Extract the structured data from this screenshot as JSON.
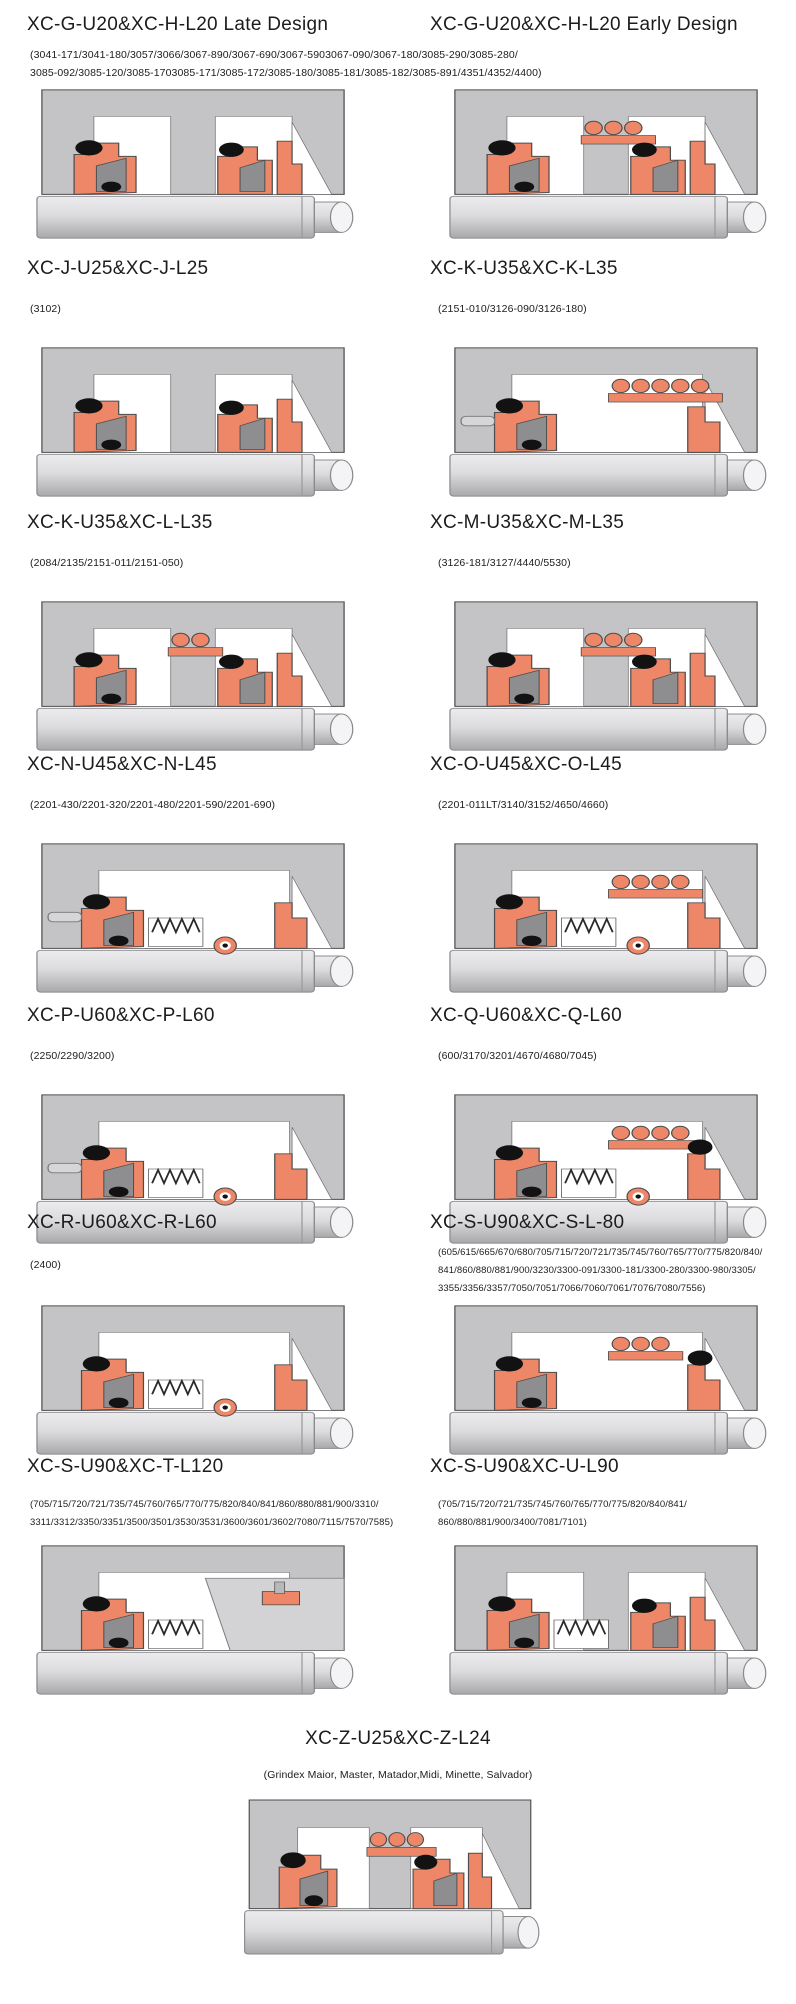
{
  "page": {
    "background": "#ffffff"
  },
  "colors": {
    "housing": "#c4c4c6",
    "cavity": "#ffffff",
    "seal_orange": "#ee8767",
    "component_black": "#121212",
    "wedge_gray": "#8e8e90",
    "shaft_light": "#dcdcde",
    "shaft_dark": "#a8a8aa",
    "outline": "#4d4d4d",
    "text": "#1c1c1c"
  },
  "rows": [
    {
      "cells": [
        {
          "title": "XC-G-U20&XC-H-L20 Late Design"
        },
        {
          "title": "XC-G-U20&XC-H-L20 Early Design"
        }
      ],
      "shared_models": "(3041-171/3041-180/3057/3066/3067-890/3067-690/3067-5903067-090/3067-180/3085-290/3085-280/\n3085-092/3085-120/3085-1703085-171/3085-172/3085-180/3085-181/3085-182/3085-891/4351/4352/4400)"
    },
    {
      "cells": [
        {
          "title": "XC-J-U25&XC-J-L25",
          "models": "(3102)"
        },
        {
          "title": "XC-K-U35&XC-K-L35",
          "models": "(2151-010/3126-090/3126-180)"
        }
      ]
    },
    {
      "cells": [
        {
          "title": "XC-K-U35&XC-L-L35",
          "models": "(2084/2135/2151-011/2151-050)"
        },
        {
          "title": "XC-M-U35&XC-M-L35",
          "models": "(3126-181/3127/4440/5530)"
        }
      ]
    },
    {
      "cells": [
        {
          "title": "XC-N-U45&XC-N-L45",
          "models": "(2201-430/2201-320/2201-480/2201-590/2201-690)"
        },
        {
          "title": "XC-O-U45&XC-O-L45",
          "models": "(2201-011LT/3140/3152/4650/4660)"
        }
      ]
    },
    {
      "cells": [
        {
          "title": "XC-P-U60&XC-P-L60",
          "models": "(2250/2290/3200)"
        },
        {
          "title": "XC-Q-U60&XC-Q-L60",
          "models": "(600/3170/3201/4670/4680/7045)"
        }
      ]
    },
    {
      "cells": [
        {
          "title": "XC-R-U60&XC-R-L60",
          "models": "(2400)"
        },
        {
          "title": "XC-S-U90&XC-S-L-80",
          "models": "(605/615/665/670/680/705/715/720/721/735/745/760/765/770/775/820/840/\n841/860/880/881/900/3230/3300-091/3300-181/3300-280/3300-980/3305/\n3355/3356/3357/7050/7051/7066/7060/7061/7076/7080/7556)"
        }
      ]
    },
    {
      "cells": [
        {
          "title": "XC-S-U90&XC-T-L120",
          "models": "(705/715/720/721/735/745/760/765/770/775/820/840/841/860/880/881/900/3310/\n3311/3312/3350/3351/3500/3501/3530/3531/3600/3601/3602/7080/7115/7570/7585)"
        },
        {
          "title": "XC-S-U90&XC-U-L90",
          "models": "(705/715/720/721/735/745/760/765/770/775/820/840/841/\n860/880/881/900/3400/7081/7101)"
        }
      ]
    },
    {
      "cells": [
        {
          "title": "XC-Z-U25&XC-Z-L24",
          "models": "(Grindex  Maior, Master, Matador,Midi, Minette, Salvador)"
        }
      ]
    }
  ]
}
